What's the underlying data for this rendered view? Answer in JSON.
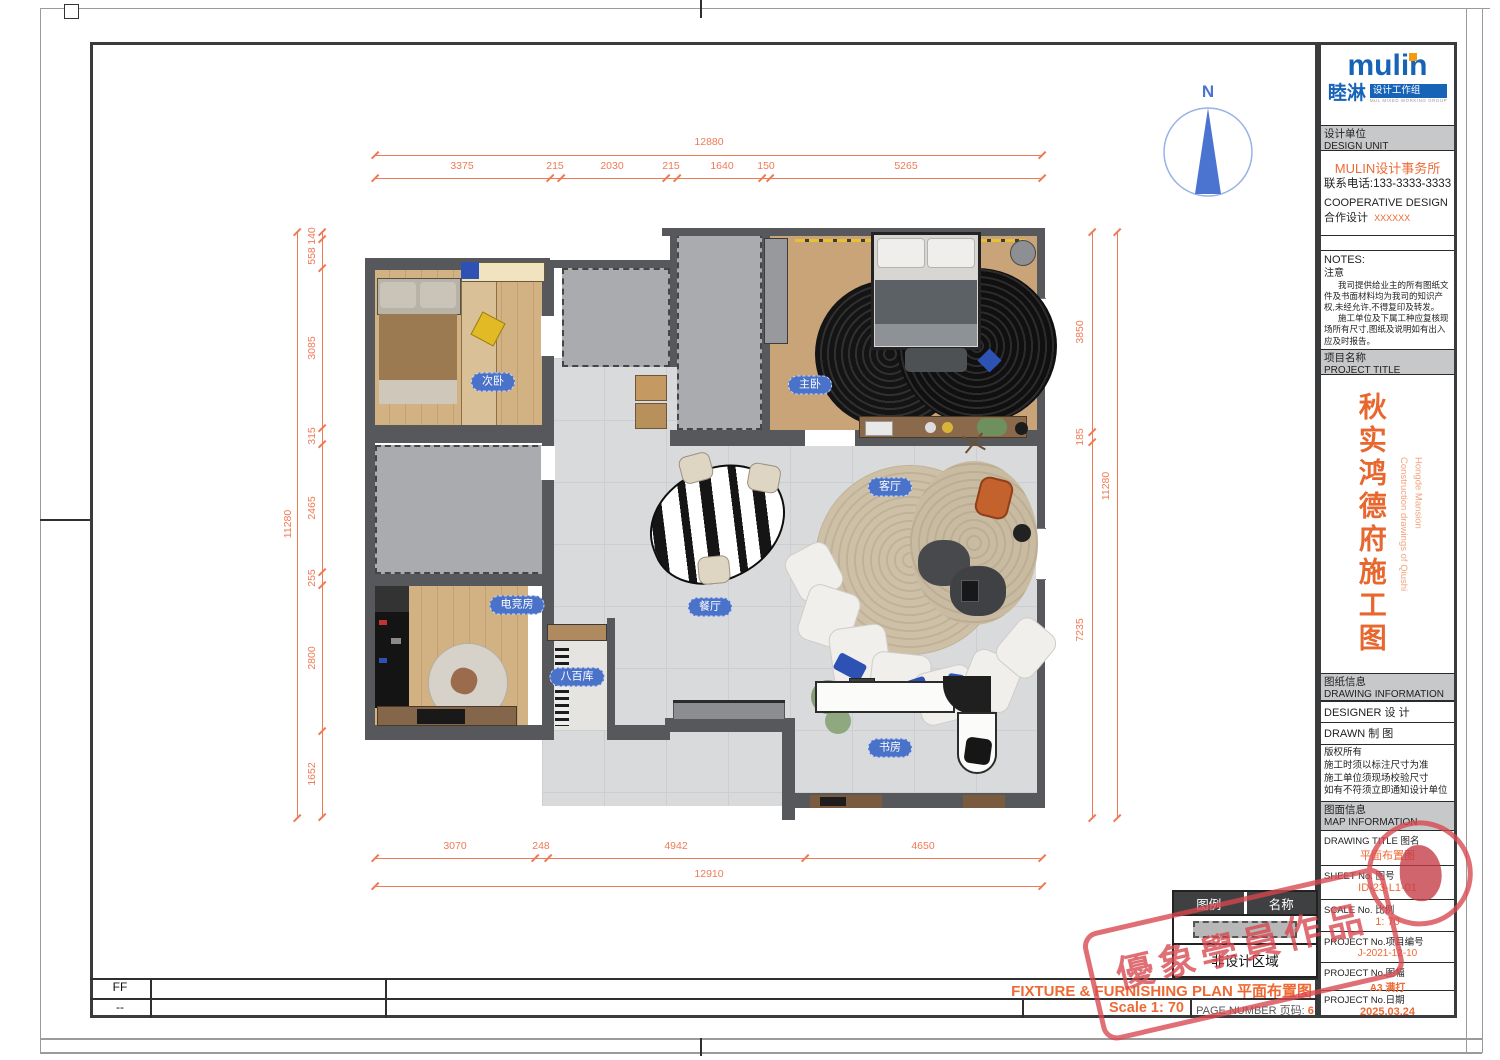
{
  "colors": {
    "accent_orange": "#ee6a35",
    "dim_orange": "#ef7a56",
    "brand_blue": "#1763b8",
    "pill_blue": "#4a72c8",
    "stamp_red": "#d8474f",
    "wall_gray": "#57585b"
  },
  "compass": {
    "label": "N"
  },
  "plan": {
    "rooms": [
      {
        "label": "次卧"
      },
      {
        "label": "主卧"
      },
      {
        "label": "客厅"
      },
      {
        "label": "餐厅"
      },
      {
        "label": "电竞房"
      },
      {
        "label": "八百库"
      },
      {
        "label": "书房"
      }
    ]
  },
  "dims": {
    "top": {
      "total": "12880",
      "segs": [
        "3375",
        "215",
        "2030",
        "215",
        "1640",
        "150",
        "5265"
      ]
    },
    "left": {
      "total": "11280",
      "segs": [
        "140",
        "558",
        "3085",
        "315",
        "2465",
        "255",
        "2800",
        "1652"
      ]
    },
    "right": {
      "total": "11280",
      "segs": [
        "3850",
        "185",
        "7235"
      ]
    },
    "bottom": {
      "total": "12910",
      "segs": [
        "3070",
        "248",
        "4942",
        "4650"
      ]
    }
  },
  "legend": {
    "legend_header": "图例",
    "name_header": "名称",
    "non_design": "非设计区域"
  },
  "footer": {
    "row_ff": "FF",
    "row_dash": "--",
    "plan_title": "FIXTURE & FURNISHING PLAN 平面布置图",
    "scale": "Scale 1:  70",
    "page_label": "PAGE NUMBER 页码:",
    "page_number": "6"
  },
  "brand": {
    "wordmark": "mulin",
    "name_cn": "睦淋",
    "group": "设计工作组",
    "tagline": "MUL MIXED WORKING GROUP"
  },
  "design_unit": {
    "header_cn": "设计单位",
    "header_en": "DESIGN UNIT",
    "firm": "MULIN设计事务所",
    "phone": "联系电话:133-3333-3333",
    "coop_en": "COOPERATIVE DESIGN",
    "coop_cn": "合作设计",
    "coop_value": "XXXXXX"
  },
  "notes": {
    "header_en": "NOTES:",
    "header_cn": "注意",
    "line1": "我司提供给业主的所有图纸文件及书面材料均为我司的知识产权,未经允许,不得复印及转发。",
    "line2": "施工单位及下属工种应复核现场所有尺寸,图纸及说明如有出入应及时报告。"
  },
  "project": {
    "header_cn": "项目名称",
    "header_en": "PROJECT TITLE",
    "title_cn": "秋实鸿德府施工图",
    "title_en_1": "Construction drawings of Qiushi",
    "title_en_2": "Hongde Mansion"
  },
  "drawing_info": {
    "header_cn": "图纸信息",
    "header_en": "DRAWING INFORMATION",
    "designer_label": "DESIGNER 设  计",
    "drawn_label": "DRAWN    制  图",
    "copyright": [
      "版权所有",
      "施工时须以标注尺寸为准",
      "施工单位须现场校验尺寸",
      "如有不符须立即通知设计单位"
    ]
  },
  "map_info": {
    "header_cn": "图面信息",
    "header_en": "MAP INFORMATION",
    "rows": [
      {
        "label": "DRAWING TITLE 图名",
        "value": "平面布置图"
      },
      {
        "label": "SHEET No. 图号",
        "value": "ID-23-L1-01"
      },
      {
        "label": "SCALE No. 比例",
        "value": "1:  70"
      },
      {
        "label": "PROJECT No.项目编号",
        "value": "J-2021-12-10"
      },
      {
        "label": "PROJECT No.图幅",
        "value": "A3 满打"
      },
      {
        "label": "PROJECT No.日期",
        "value": "2025.03.24"
      }
    ]
  },
  "stamp": {
    "text": "優象學員作品"
  }
}
